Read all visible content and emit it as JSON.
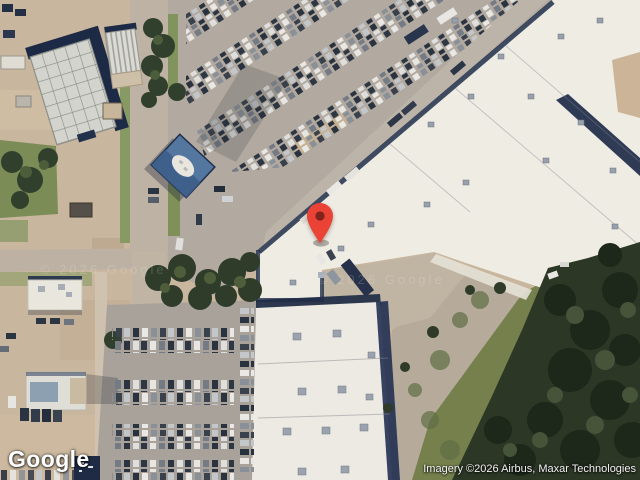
{
  "map": {
    "view_type": "satellite",
    "watermark_text": "© 2026 Google",
    "pin": {
      "color": "#EA4335",
      "inner_color": "#7F231C"
    },
    "colors": {
      "dirt": "#c9b69e",
      "concrete": "#b3aaa0",
      "road": "#bdb2a4",
      "roof_white": "#efece4",
      "roof_blue": "#54779f",
      "shadow_navy": "#1e2c49",
      "grass": "#76804d",
      "forest": "#2c3725"
    }
  },
  "branding": {
    "logo_text": "Google"
  },
  "attribution": {
    "text": "Imagery ©2026 Airbus, Maxar Technologies"
  }
}
